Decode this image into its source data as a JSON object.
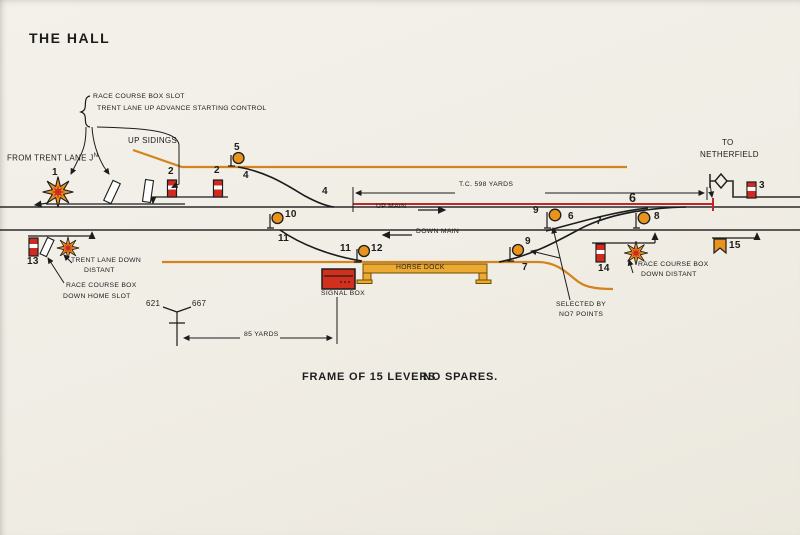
{
  "title": "THE HALL",
  "colors": {
    "paper": "#f0ede5",
    "ink": "#1c1c1c",
    "track_orange": "#d4841c",
    "track_circuit_red": "#c1272d",
    "signal_red": "#cf2b20",
    "disc_orange": "#e8931c",
    "dock_yellow": "#ecaa33"
  },
  "annotations": {
    "race_course_box_slot": "RACE COURSE BOX SLOT",
    "trent_lane_up_advance": "TRENT LANE UP ADVANCE STARTING CONTROL",
    "from_trent_lane": "FROM TRENT LANE J",
    "from_trent_lane_sup": "N",
    "up_sidings": "UP SIDINGS",
    "to": "TO",
    "netherfield": "NETHERFIELD",
    "track_circuit": "T.C. 598 YARDS",
    "up_main": "UP MAIN",
    "down_main": "DOWN MAIN",
    "horse_dock": "HORSE DOCK",
    "signal_box": "SIGNAL BOX",
    "trent_lane_down_1": "TRENT LANE DOWN",
    "trent_lane_down_2": "DISTANT",
    "race_home_slot_1": "RACE COURSE BOX",
    "race_home_slot_2": "DOWN HOME SLOT",
    "race_down_distant_1": "RACE COURSE BOX",
    "race_down_distant_2": "DOWN DISTANT",
    "selected_by_1": "SELECTED BY",
    "selected_by_2": "NO7 POINTS",
    "frame": "FRAME OF 15 LEVERS",
    "no_spares": "NO SPARES.",
    "milepost_left": "621",
    "milepost_right": "667",
    "yards_85": "85 YARDS"
  },
  "lever_numbers": {
    "n1": "1",
    "n2a": "2",
    "n2b": "2",
    "n3": "3",
    "n4a": "4",
    "n4b": "4",
    "n5": "5",
    "n6a": "6",
    "n6b": "6",
    "n7a": "7",
    "n7b": "7",
    "n8": "8",
    "n9a": "9",
    "n9b": "9",
    "n10": "10",
    "n11a": "11",
    "n11b": "11",
    "n12": "12",
    "n13": "13",
    "n14": "14",
    "n15": "15"
  }
}
